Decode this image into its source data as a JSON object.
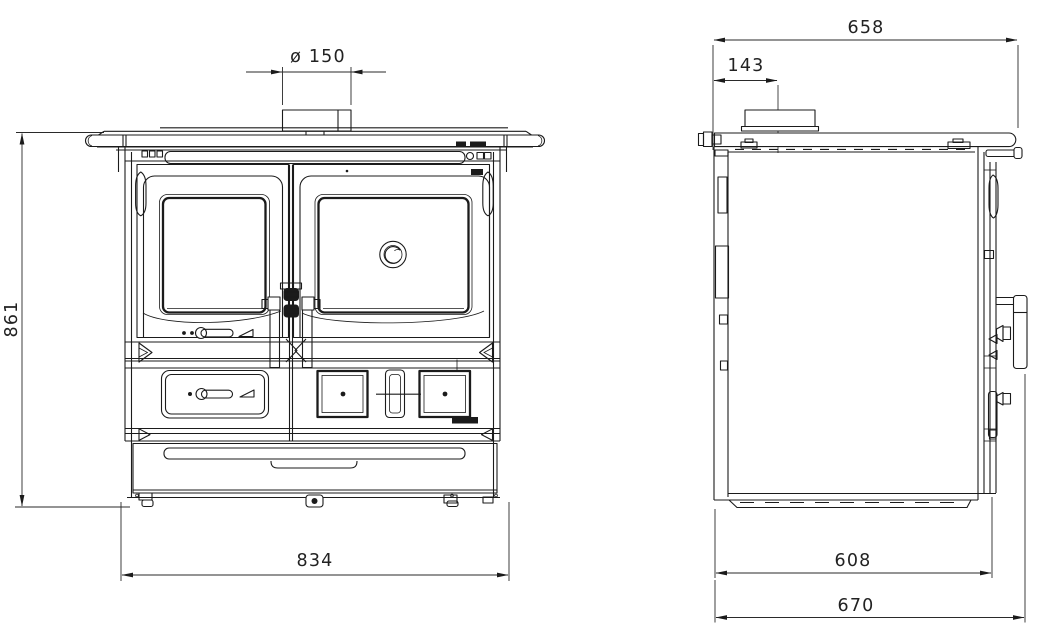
{
  "views": {
    "front": {
      "flue_diameter": "ø 150",
      "height": "861",
      "width": "834"
    },
    "side": {
      "top_depth": "658",
      "flue_offset_from_back": "143",
      "body_depth": "608",
      "overall_depth": "670"
    }
  },
  "style": {
    "line_color": "#1b1b1b",
    "background": "#ffffff",
    "text_color": "#222222"
  }
}
